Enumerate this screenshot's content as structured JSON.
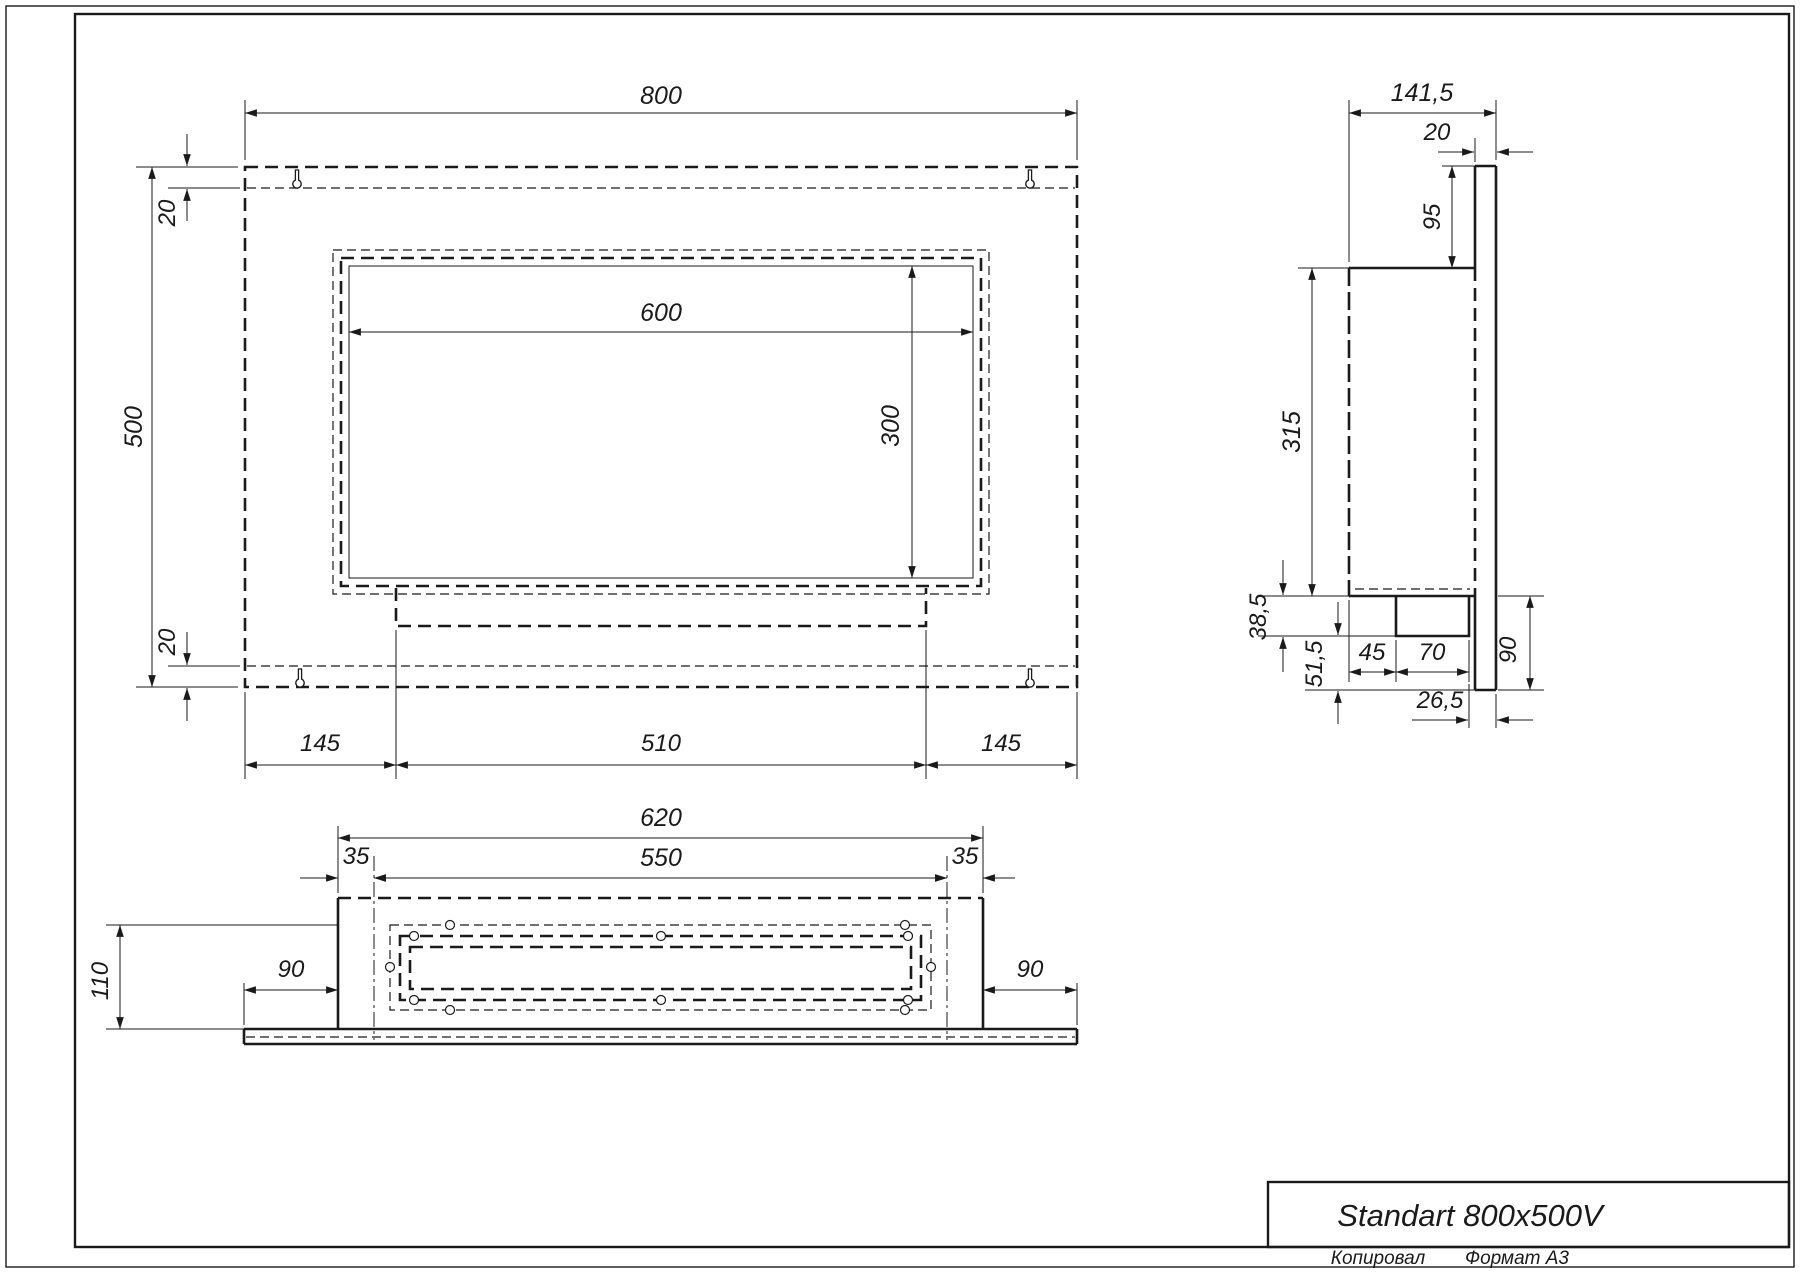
{
  "title_block": {
    "product_name": "Standart 800x500V"
  },
  "sheet": {
    "copied_label": "Копировал",
    "format_label": "Формат А3"
  },
  "front_view": {
    "width": "800",
    "height": "500",
    "flange_top": "20",
    "flange_bottom": "20",
    "opening_width": "600",
    "opening_height": "300",
    "margin_left": "145",
    "tray_width": "510",
    "margin_right": "145"
  },
  "bottom_view": {
    "body_width": "620",
    "inner_width": "550",
    "inset_left": "35",
    "inset_right": "35",
    "depth": "110",
    "wing_left": "90",
    "wing_right": "90"
  },
  "side_view": {
    "total_depth": "141,5",
    "plate_thickness": "20",
    "top_offset": "95",
    "chamber_height": "315",
    "tray_drop": "38,5",
    "below_tray": "51,5",
    "tray_offset": "45",
    "tray_depth": "70",
    "back_gap": "26,5",
    "plate_below": "90"
  }
}
